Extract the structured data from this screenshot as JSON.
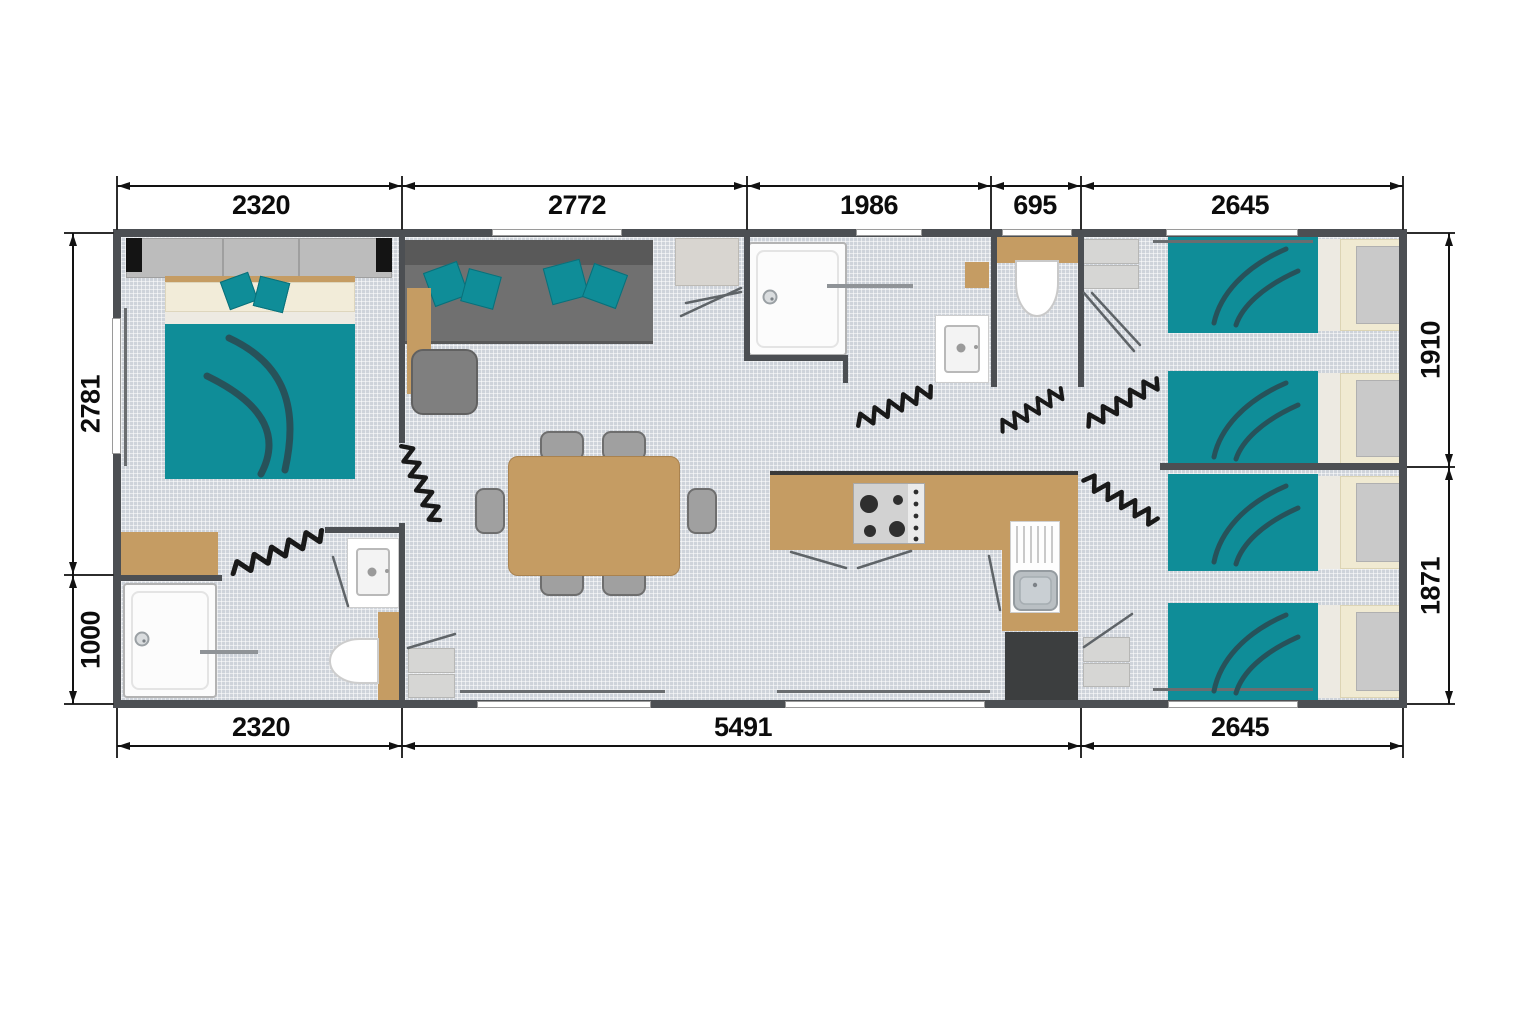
{
  "dimensions_mm": {
    "top": [
      "2320",
      "2772",
      "1986",
      "695",
      "2645"
    ],
    "bottom": [
      "2320",
      "5491",
      "2645"
    ],
    "left": [
      "2781",
      "1000"
    ],
    "right": [
      "1910",
      "1871"
    ]
  },
  "colors": {
    "teal_fabric": "#0F8D98",
    "swoosh_dark": "#27525A",
    "wood_tan": "#C59C63",
    "wall_gray": "#4C4F53",
    "floor_tile": "#CED3DA",
    "sofa_gray": "#707070"
  }
}
